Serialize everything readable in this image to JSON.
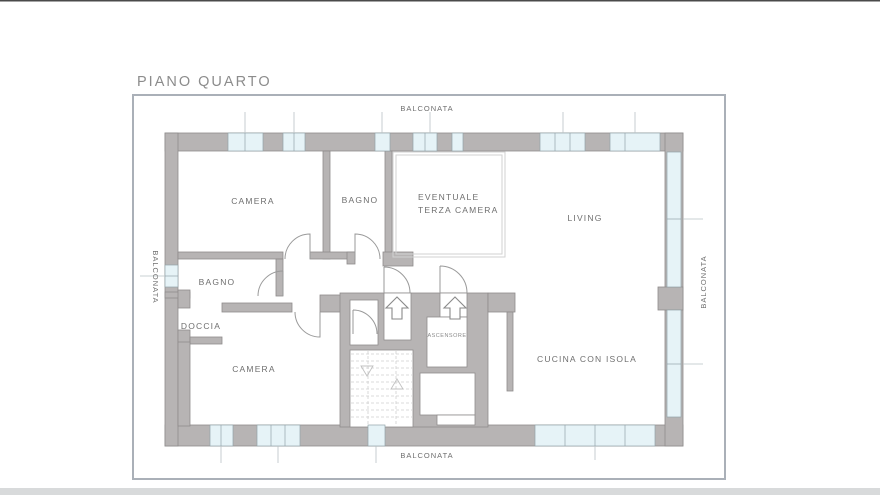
{
  "title": "PIANO QUARTO",
  "balconies": {
    "top": "BALCONATA",
    "bottom": "BALCONATA",
    "left": "BALCONATA",
    "right": "BALCONATA"
  },
  "rooms": {
    "camera_top": "CAMERA",
    "bagno_top": "BAGNO",
    "terza_line1": "EVENTUALE",
    "terza_line2": "TERZA CAMERA",
    "living": "LIVING",
    "bagno_mid": "BAGNO",
    "doccia": "DOCCIA",
    "camera_bottom": "CAMERA",
    "ascensore": "ASCENSORE",
    "cucina": "CUCINA CON ISOLA"
  },
  "colors": {
    "wall": "#b7b4b4",
    "outline": "#8f8c8c",
    "window": "#e6f3f7",
    "winstroke": "#93a3a8",
    "label": "#6f6f6f",
    "title": "#8c8c8c",
    "frame": "#aab0b8"
  }
}
